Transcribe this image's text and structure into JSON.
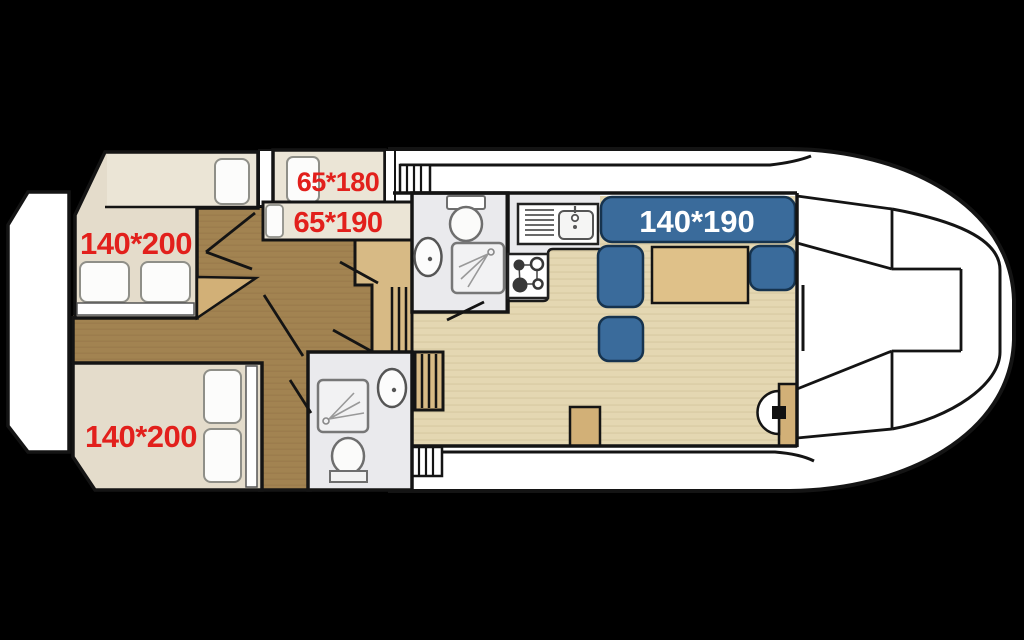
{
  "plan": {
    "title": "boat-deck-floorplan",
    "rooms": {
      "aft_cabin_top": {
        "name": "double-cabin-port",
        "bed_label": "140*200"
      },
      "aft_cabin_bottom": {
        "name": "double-cabin-starboard",
        "bed_label": "140*200"
      },
      "bunk_cabin": {
        "name": "bunk-cabin",
        "top_bunk_label": "65*180",
        "bottom_bunk_label": "65*190"
      },
      "salon": {
        "name": "salon",
        "bench_label": "140*190"
      }
    },
    "colors": {
      "background": "#000000",
      "hull_white": "#ffffff",
      "outline": "#141414",
      "cabin_floor": "#e4dccb",
      "bed_surface": "#ebe5d6",
      "hallway": "#a28351",
      "wood": "#d2b077",
      "step_wood": "#d7ba85",
      "salon_floor": "#e4d7b2",
      "salon_floor_stripe": "#d9cba3",
      "table_wood": "#dfc189",
      "seat_blue": "#3a6b9b",
      "seat_outline": "#16334e",
      "bath_floor": "#eaeaed",
      "fixture_white": "#fcfcfb",
      "label_red": "#e2201c",
      "label_white": "#ffffff"
    },
    "icons": [
      "toilet-icon",
      "sink-icon",
      "shower-icon",
      "stove-icon",
      "kitchen-sink-icon",
      "steering-wheel-icon",
      "bed-pillow-icon",
      "stairs-icon",
      "door-swing-icon"
    ]
  }
}
